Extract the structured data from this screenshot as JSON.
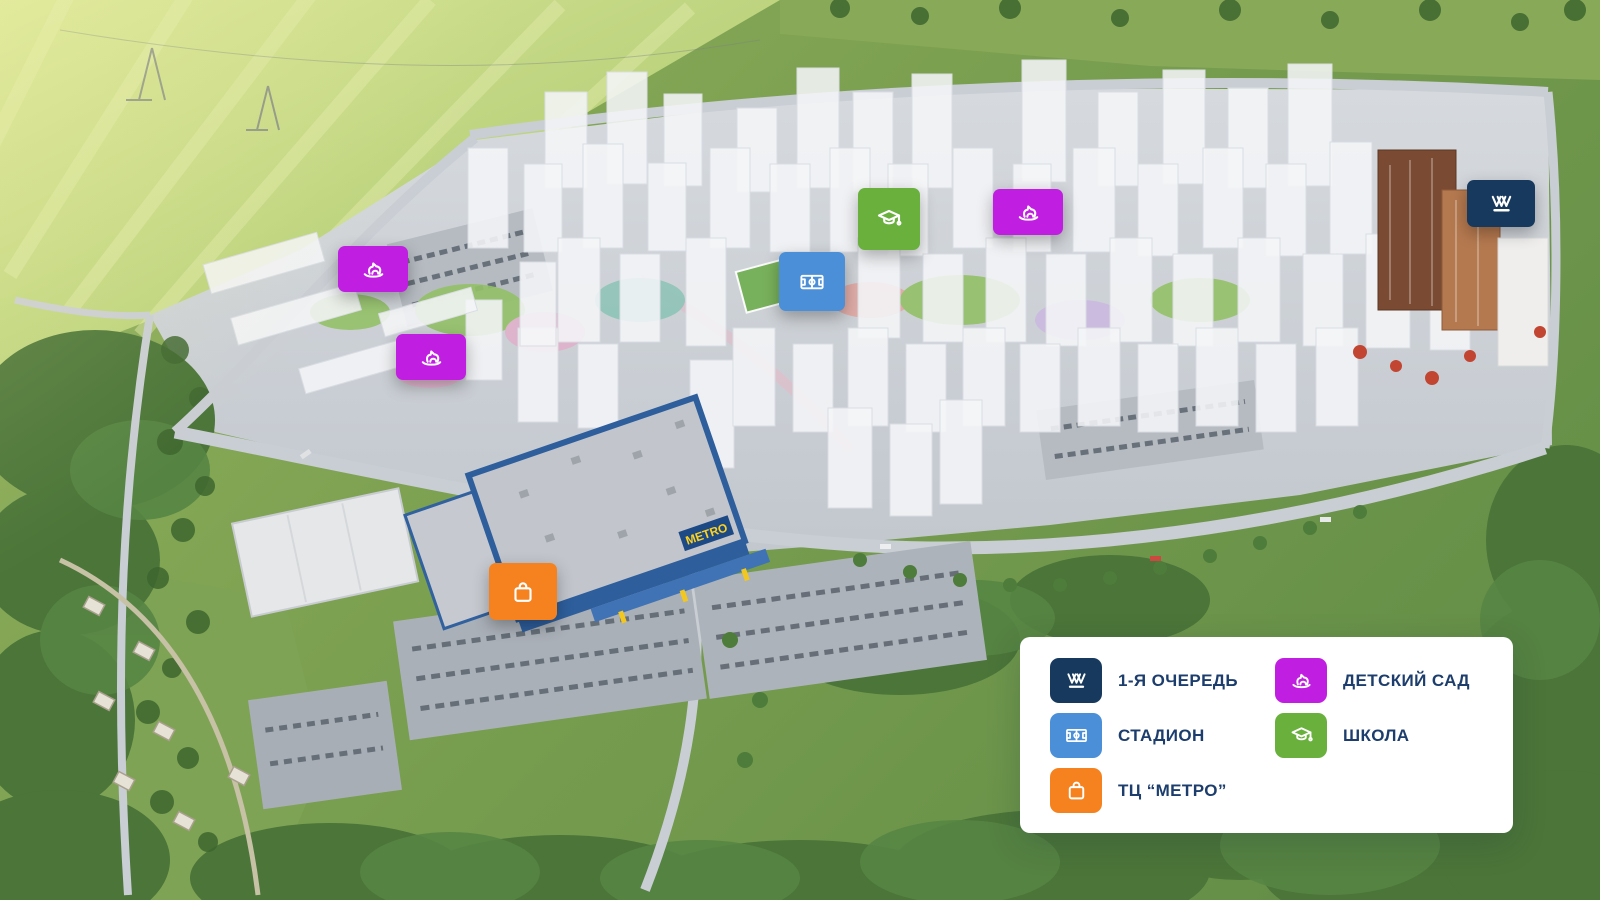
{
  "map": {
    "metro_sign": "METRO",
    "markers": [
      {
        "name": "first-phase",
        "icon": "vvv-logo-icon",
        "color": "#17395e",
        "rect": {
          "x": 1467,
          "y": 180,
          "w": 68,
          "h": 47
        }
      },
      {
        "name": "kindergarten-1",
        "icon": "rocking-horse-icon",
        "color": "#c01fe2",
        "rect": {
          "x": 338,
          "y": 246,
          "w": 70,
          "h": 46
        }
      },
      {
        "name": "kindergarten-2",
        "icon": "rocking-horse-icon",
        "color": "#c01fe2",
        "rect": {
          "x": 396,
          "y": 334,
          "w": 70,
          "h": 46
        }
      },
      {
        "name": "kindergarten-3",
        "icon": "rocking-horse-icon",
        "color": "#c01fe2",
        "rect": {
          "x": 993,
          "y": 189,
          "w": 70,
          "h": 46
        }
      },
      {
        "name": "school",
        "icon": "graduation-cap-icon",
        "color": "#69b03c",
        "rect": {
          "x": 858,
          "y": 188,
          "w": 62,
          "h": 62
        }
      },
      {
        "name": "stadium",
        "icon": "stadium-icon",
        "color": "#4a8fd8",
        "rect": {
          "x": 779,
          "y": 252,
          "w": 66,
          "h": 59
        }
      },
      {
        "name": "metro-mall",
        "icon": "shopping-bag-icon",
        "color": "#f6821f",
        "rect": {
          "x": 489,
          "y": 563,
          "w": 68,
          "h": 57
        }
      }
    ]
  },
  "legend": {
    "panel_bg": "#ffffff",
    "text_color": "#1d3e6d",
    "items": [
      {
        "icon": "vvv-logo-icon",
        "color": "#17395e",
        "label": "1-Я ОЧЕРЕДЬ"
      },
      {
        "icon": "stadium-icon",
        "color": "#4a8fd8",
        "label": "СТАДИОН"
      },
      {
        "icon": "shopping-bag-icon",
        "color": "#f6821f",
        "label": "ТЦ “МЕТРО”"
      },
      {
        "icon": "rocking-horse-icon",
        "color": "#c01fe2",
        "label": "ДЕТСКИЙ САД"
      },
      {
        "icon": "graduation-cap-icon",
        "color": "#69b03c",
        "label": "ШКОЛА"
      }
    ]
  }
}
